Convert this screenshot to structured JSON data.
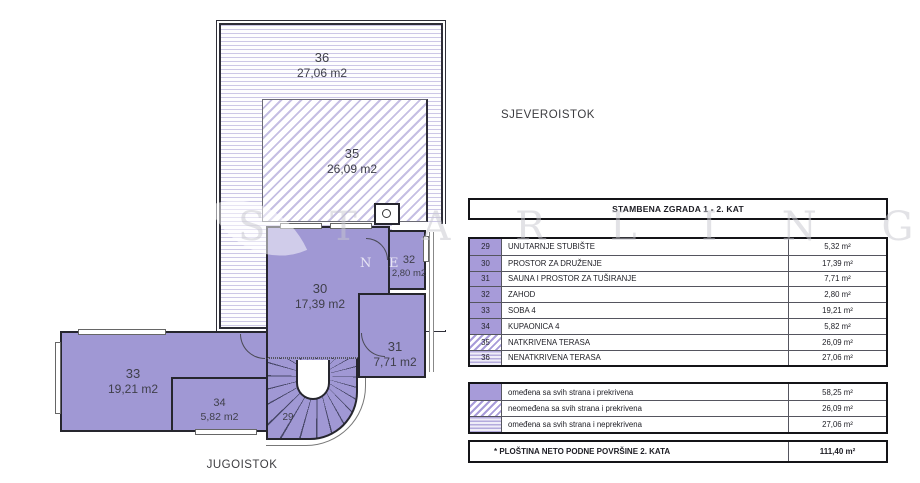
{
  "compass": {
    "northeast": "SJEVEROISTOK",
    "southeast": "JUGOISTOK"
  },
  "watermark": {
    "brand": "STARLING",
    "display": "S T A R L I N G",
    "sub_left": "N",
    "sub_right": "E"
  },
  "floor_plan": {
    "rooms": [
      {
        "id": "36",
        "area": "27,06 m2",
        "pattern": "horizontal-lines"
      },
      {
        "id": "35",
        "area": "26,09 m2",
        "pattern": "diagonal-hatch"
      },
      {
        "id": "30",
        "area": "17,39 m2",
        "pattern": "solid"
      },
      {
        "id": "32",
        "area": "2,80 m2",
        "pattern": "solid"
      },
      {
        "id": "31",
        "area": "7,71 m2",
        "pattern": "solid"
      },
      {
        "id": "33",
        "area": "19,21 m2",
        "pattern": "solid"
      },
      {
        "id": "34",
        "area": "5,82 m2",
        "pattern": "solid"
      },
      {
        "id": "29",
        "area": "",
        "pattern": "stairs"
      }
    ]
  },
  "table": {
    "title": "STAMBENA ZGRADA 1 - 2. KAT",
    "rows": [
      {
        "num": "29",
        "name": "UNUTARNJE STUBIŠTE",
        "area": "5,32 m²",
        "swatch": "solid"
      },
      {
        "num": "30",
        "name": "PROSTOR ZA DRUŽENJE",
        "area": "17,39 m²",
        "swatch": "solid"
      },
      {
        "num": "31",
        "name": "SAUNA I PROSTOR ZA TUŠIRANJE",
        "area": "7,71 m²",
        "swatch": "solid"
      },
      {
        "num": "32",
        "name": "ZAHOD",
        "area": "2,80 m²",
        "swatch": "solid"
      },
      {
        "num": "33",
        "name": "SOBA 4",
        "area": "19,21 m²",
        "swatch": "solid"
      },
      {
        "num": "34",
        "name": "KUPAONICA 4",
        "area": "5,82 m²",
        "swatch": "solid"
      },
      {
        "num": "35",
        "name": "NATKRIVENA TERASA",
        "area": "26,09 m²",
        "swatch": "diag"
      },
      {
        "num": "36",
        "name": "NENATKRIVENA TERASA",
        "area": "27,06 m²",
        "swatch": "hlines"
      }
    ],
    "legend": [
      {
        "name": "omeđena sa svih strana i prekrivena",
        "area": "58,25 m²",
        "swatch": "solid"
      },
      {
        "name": "neomeđena sa svih strana i prekrivena",
        "area": "26,09 m²",
        "swatch": "diag"
      },
      {
        "name": "omeđena sa svih strana i neprekrivena",
        "area": "27,06 m²",
        "swatch": "hlines"
      }
    ],
    "total": {
      "name": "* PLOŠTINA NETO PODNE POVRŠINE  2. KATA",
      "area": "111,40 m²"
    }
  },
  "colors": {
    "room_fill": "#a098d4",
    "wall": "#26262e",
    "hatch_line": "#c5bfe3",
    "table_border": "#141418"
  }
}
